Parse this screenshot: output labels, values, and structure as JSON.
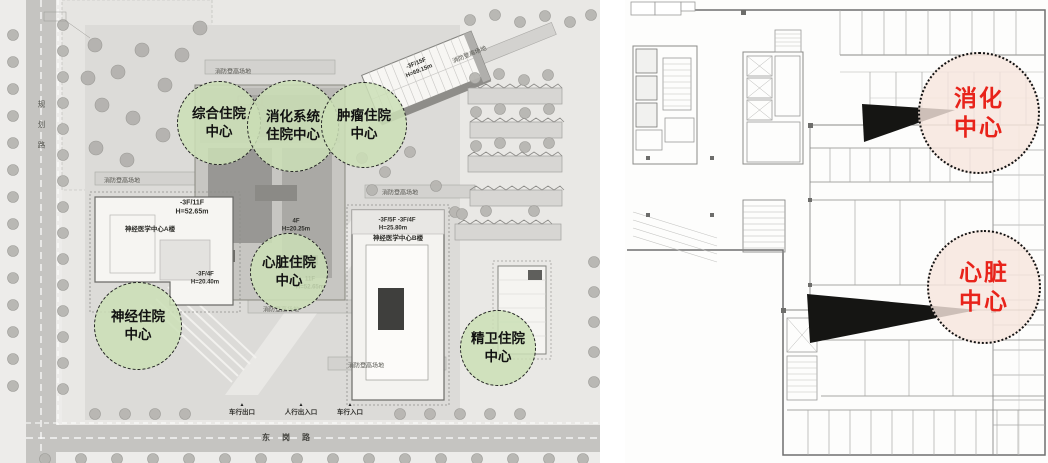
{
  "colors": {
    "green_bubble_fill": "#cbdfb6",
    "pink_bubble_fill": "#f7e5dd",
    "red_center_text": "#e8231a",
    "plan_ground_gray": "#d9d8d5",
    "road_gray": "#c5c4c1"
  },
  "left_plan": {
    "roads": {
      "left_vertical": "规划路",
      "bottom": "东岗路"
    },
    "fire_access_label": "消防登高场地",
    "entrance_marker": "▲",
    "entrances": [
      "车行出口",
      "人行出入口",
      "车行入口"
    ],
    "buildings": {
      "a_block": {
        "floors": "-3F/11F",
        "height": "H=52.65m",
        "name": "神经医学中心A楼"
      },
      "b_block": {
        "floors": "-3F/5F -3F/4F",
        "height": "H=25.80m",
        "name": "神经医学中心B楼"
      },
      "ne_tower": {
        "label": "-3F/15F\nH=69.15m"
      },
      "podium": {
        "label": "4F\nH=20.25m"
      },
      "mid_block": {
        "label": "-3F/4F\nH=20.40m"
      },
      "c_tower": {
        "label": "11F\nH=52.65m"
      }
    },
    "bubbles": [
      {
        "id": "comprehensive-inpatient",
        "label": "综合住院\n中心"
      },
      {
        "id": "digestive-inpatient",
        "label": "消化系统\n住院中心"
      },
      {
        "id": "oncology-inpatient",
        "label": "肿瘤住院\n中心"
      },
      {
        "id": "cardiac-inpatient",
        "label": "心脏住院\n中心"
      },
      {
        "id": "neurology-inpatient",
        "label": "神经住院\n中心"
      },
      {
        "id": "psychiatric-inpatient",
        "label": "精卫住院\n中心"
      }
    ]
  },
  "right_plan": {
    "bubbles": [
      {
        "id": "digestive-center",
        "label": "消化\n中心"
      },
      {
        "id": "cardiac-center",
        "label": "心脏\n中心"
      }
    ]
  }
}
